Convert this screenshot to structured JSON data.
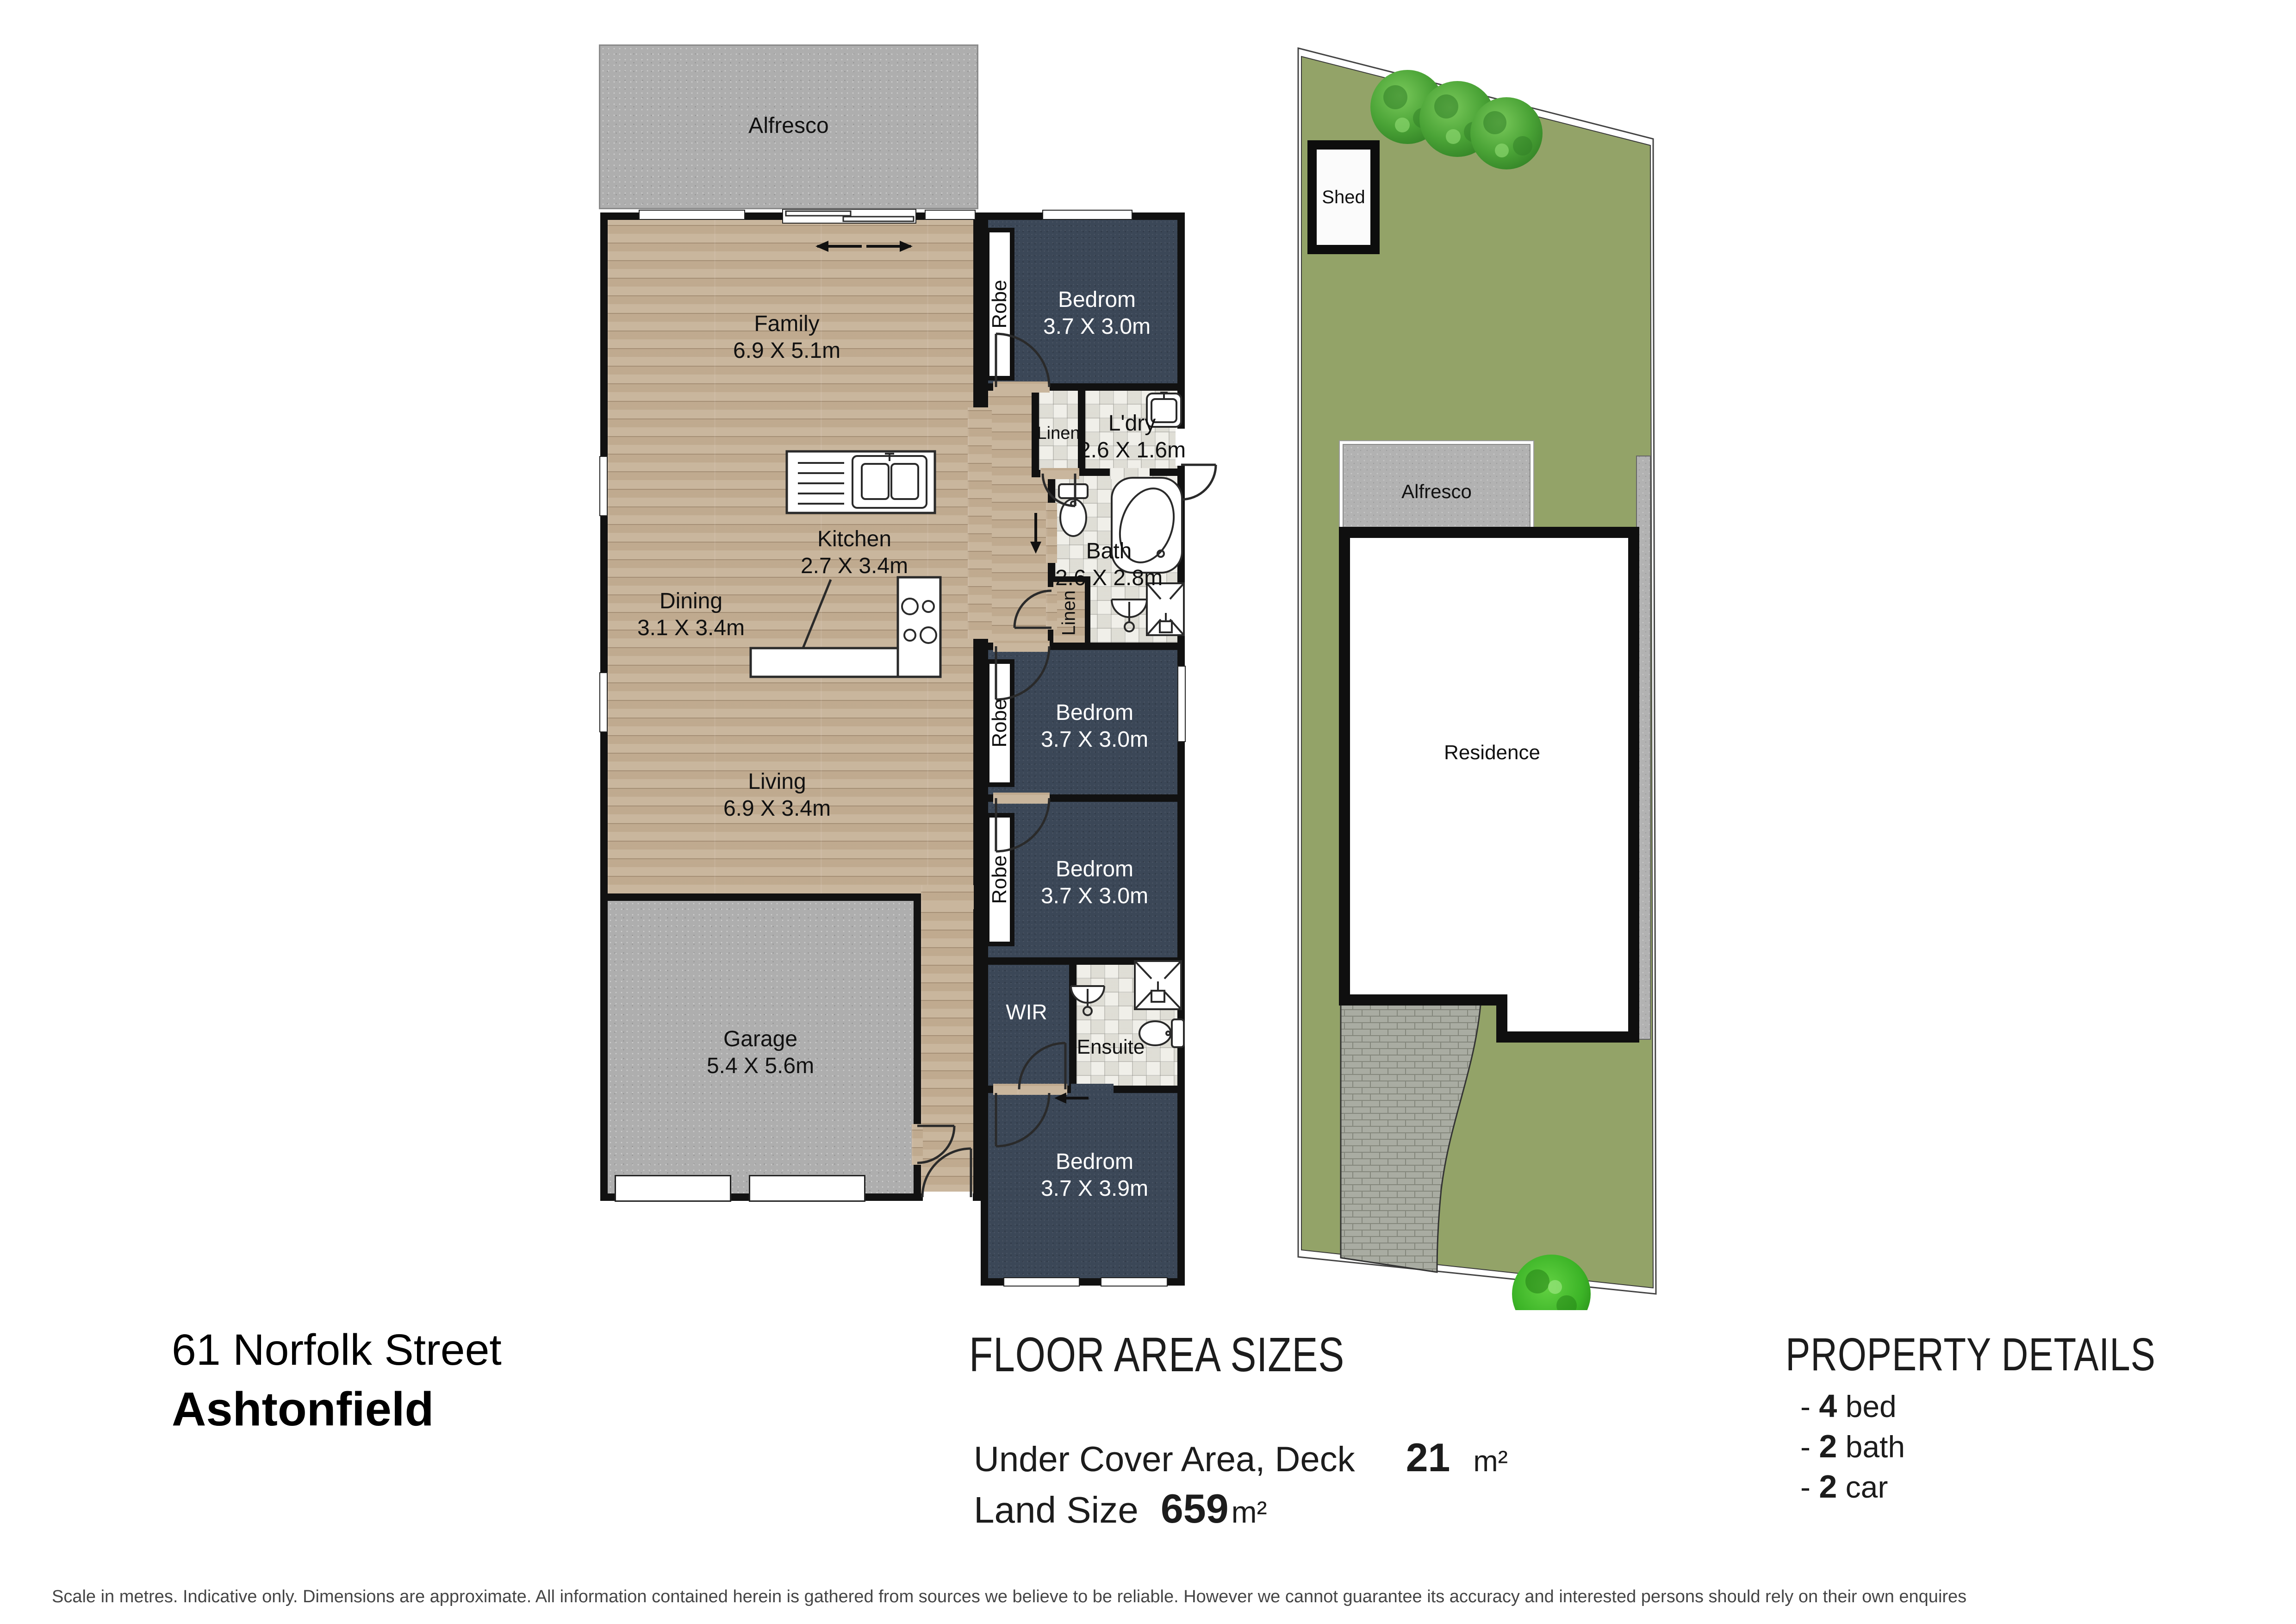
{
  "floor_plan": {
    "alfresco": {
      "name": "Alfresco"
    },
    "family": {
      "name": "Family",
      "size": "6.9 X 5.1m"
    },
    "kitchen": {
      "name": "Kitchen",
      "size": "2.7 X 3.4m"
    },
    "dining": {
      "name": "Dining",
      "size": "3.1 X 3.4m"
    },
    "living": {
      "name": "Living",
      "size": "6.9 X 3.4m"
    },
    "garage": {
      "name": "Garage",
      "size": "5.4 X 5.6m"
    },
    "bedroom_top": {
      "name": "Bedrom",
      "size": "3.7 X 3.0m"
    },
    "bedroom_mid1": {
      "name": "Bedrom",
      "size": "3.7 X 3.0m"
    },
    "bedroom_mid2": {
      "name": "Bedrom",
      "size": "3.7 X 3.0m"
    },
    "bedroom_rear": {
      "name": "Bedrom",
      "size": "3.7 X 3.9m"
    },
    "laundry": {
      "name": "L'dry",
      "size": "2.6 X 1.6m"
    },
    "bath": {
      "name": "Bath",
      "size": "2.6 X 2.8m"
    },
    "ensuite": {
      "name": "Ensuite"
    },
    "wir": {
      "name": "WIR"
    },
    "linen": {
      "name": "Linen"
    },
    "robe": {
      "name": "Robe"
    }
  },
  "site_plan": {
    "shed": {
      "name": "Shed"
    },
    "alfresco": {
      "name": "Alfresco"
    },
    "residence": {
      "name": "Residence"
    }
  },
  "address": {
    "line1": "61 Norfolk Street",
    "line2": "Ashtonfield"
  },
  "floor_areas": {
    "title": "FLOOR AREA SIZES",
    "rows": [
      {
        "label": "Under Cover Area, Deck",
        "value": "21",
        "unit": "m²"
      },
      {
        "label": "Land Size",
        "value": "659",
        "unit": "m²"
      }
    ]
  },
  "property_details": {
    "title": "PROPERTY DETAILS",
    "items": [
      {
        "prefix": "-",
        "value": "4",
        "label": "bed"
      },
      {
        "prefix": "-",
        "value": "2",
        "label": "bath"
      },
      {
        "prefix": "-",
        "value": "2",
        "label": "car"
      }
    ]
  },
  "disclaimer": "Scale in metres. Indicative only. Dimensions are approximate. All information contained herein is gathered from sources we believe to be reliable. However we cannot guarantee its accuracy and interested persons should rely on their own enquires",
  "colors": {
    "lawn": "#93a368",
    "carpet": "#3b4757",
    "wood": "#c6b197",
    "tile": "#f0efe9",
    "concrete": "#aeaeae",
    "wall": "#111111"
  }
}
